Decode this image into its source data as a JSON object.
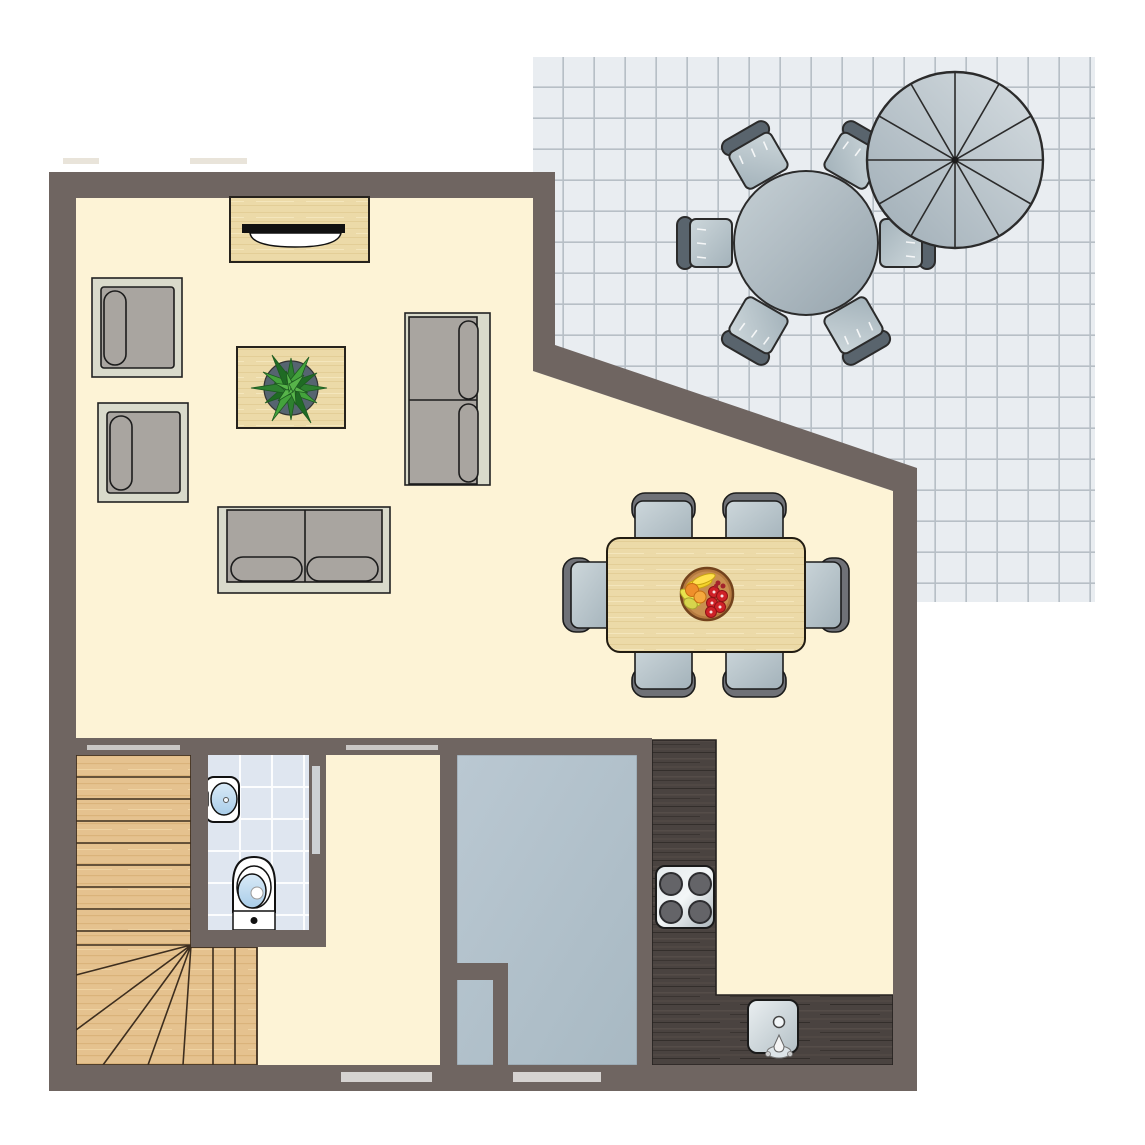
{
  "plan": {
    "type": "apartment-floor-plan-top-view",
    "canvas": {
      "width": 1145,
      "height": 1145
    },
    "colors": {
      "wall": "#6f6561",
      "floor": "#fdf3d6",
      "patio_tile": "#e9edf1",
      "patio_tile_grid": "#b7bfc6",
      "bathroom_tile": "#dfe6f0",
      "utility_floor": "#b3c2cc",
      "sofa_frame": "#d9dacb",
      "sofa_cushion": "#a9a5a0",
      "dining_chair_back": "#6f7177",
      "patio_chair_back": "#59646d",
      "wood_pale": "#ecdaa8",
      "wood_stairs": "#e5c28f",
      "wood_dark_counter": "#4a4340",
      "window_marker": "#d6d3d1",
      "door_marker": "#c9c7c5",
      "plant_green": "#2e8030",
      "outline": "#1f1f1f"
    },
    "rooms": [
      {
        "name": "living-room",
        "floor": "cream"
      },
      {
        "name": "dining-area",
        "floor": "cream"
      },
      {
        "name": "hallway",
        "floor": "cream"
      },
      {
        "name": "staircase",
        "floor": "wood",
        "shape": "quarter-turn-winder"
      },
      {
        "name": "bathroom",
        "floor": "blue-tiles"
      },
      {
        "name": "utility-room",
        "floor": "gray"
      },
      {
        "name": "kitchen",
        "counter": "dark-wood-L-shape"
      },
      {
        "name": "patio-terrace",
        "floor": "gray-tiles"
      }
    ],
    "furniture": {
      "living_room": [
        {
          "item": "sideboard-with-tv",
          "count": 1
        },
        {
          "item": "armchair",
          "count": 2
        },
        {
          "item": "coffee-table-with-plant",
          "count": 1
        },
        {
          "item": "two-seat-sofa",
          "count": 2
        }
      ],
      "dining_area": [
        {
          "item": "dining-table",
          "count": 1
        },
        {
          "item": "dining-chair",
          "count": 6
        },
        {
          "item": "fruit-bowl",
          "count": 1
        }
      ],
      "kitchen": [
        {
          "item": "l-shaped-counter",
          "count": 1
        },
        {
          "item": "hob-four-burners",
          "count": 1
        },
        {
          "item": "kitchen-sink",
          "count": 1
        }
      ],
      "bathroom": [
        {
          "item": "washbasin",
          "count": 1
        },
        {
          "item": "toilet",
          "count": 1
        }
      ],
      "patio": [
        {
          "item": "round-table",
          "count": 1
        },
        {
          "item": "patio-chair",
          "count": 6
        },
        {
          "item": "parasol-12-segments",
          "count": 1
        }
      ],
      "openings": [
        {
          "item": "door-opening-marker",
          "count": 2
        },
        {
          "item": "sliding-door-marker",
          "count": 1
        },
        {
          "item": "window-marker",
          "count": 2
        }
      ]
    }
  }
}
